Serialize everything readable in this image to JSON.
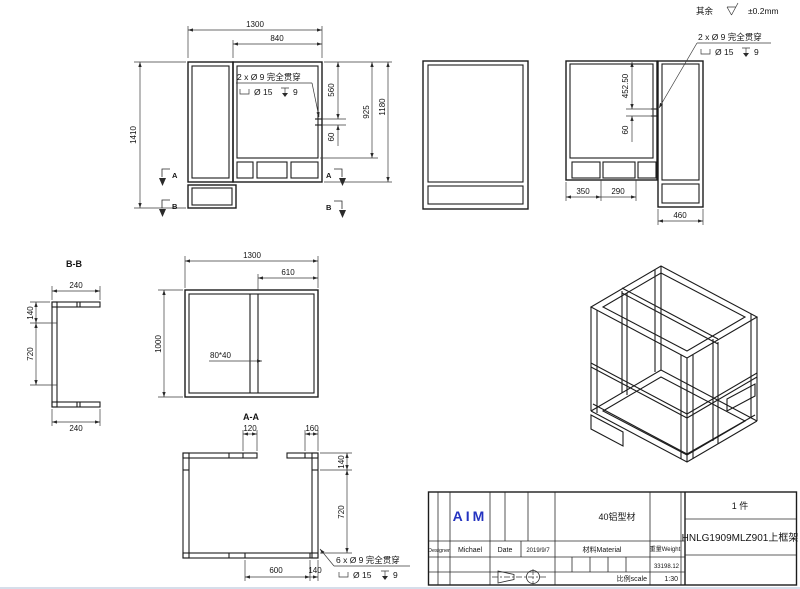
{
  "general_note": {
    "prefix": "其余",
    "tolerance": "±0.2mm"
  },
  "annotations": {
    "holes2": {
      "line1": "2 x Ø 9 完全贯穿",
      "cbore": "Ø 15",
      "depth": "9"
    },
    "holes6": {
      "line1": "6 x Ø 9 完全贯穿",
      "cbore": "Ø 15",
      "depth": "9"
    }
  },
  "section_markers": {
    "a": "A",
    "b": "B"
  },
  "front_view": {
    "dims": {
      "w_total": "1300",
      "w_opening": "840",
      "h_total": "1410",
      "hole_top": "560",
      "h_opening": "925",
      "h_right": "1180",
      "hole_gap": "60"
    }
  },
  "side_view": {
    "dims": {
      "hole_top": "452.50",
      "hole_gap": "60",
      "seg_left": "350",
      "seg_mid": "290",
      "w_right": "460"
    }
  },
  "bb_section": {
    "label": "B-B",
    "dims": {
      "arm_top": "240",
      "offset_top": "140",
      "span": "720",
      "arm_bottom": "240"
    }
  },
  "top_view": {
    "dims": {
      "w_total": "1300",
      "w_right": "610",
      "depth": "1000",
      "profile": "80*40"
    }
  },
  "aa_section": {
    "label": "A-A",
    "dims": {
      "tab_left": "120",
      "tab_right": "160",
      "offset_top": "140",
      "span": "720",
      "bottom_span": "600",
      "bottom_right": "140"
    }
  },
  "title_block": {
    "brand": "AIM",
    "material_type": "40铝型材",
    "quantity": "1 件",
    "part_number": "HNLG1909MLZ901上框架",
    "designer_label": "Designer",
    "designer": "Michael",
    "date_label": "Date",
    "date": "2019/9/7",
    "material_label": "材料Material",
    "weight_label": "重量Weight",
    "weight": "33198.12",
    "scale_label": "比例scale",
    "scale": "1:30"
  }
}
